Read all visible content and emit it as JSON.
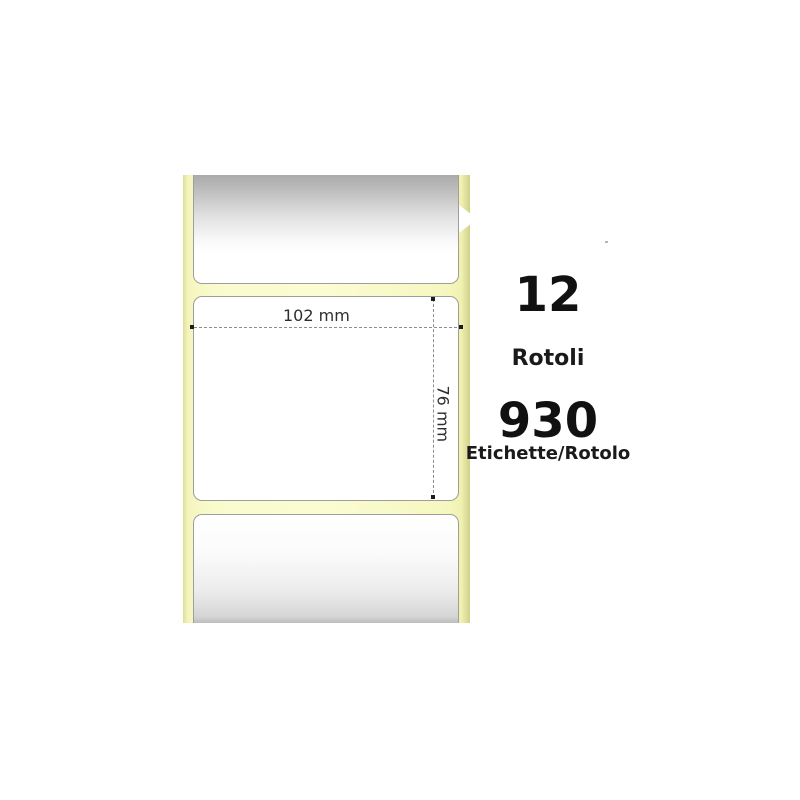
{
  "product_image": {
    "description": "Strip of three blank thermal labels on yellow liner",
    "liner_color": "#fbfcd2",
    "label_border_color": "#9e9e9e"
  },
  "dimensions": {
    "width_label": "102 mm",
    "height_label": "76 mm"
  },
  "info": {
    "rolls_count": "12",
    "rolls_label": "Rotoli",
    "labels_per_roll_count": "930",
    "labels_per_roll_label": "Etichette/Rotolo"
  }
}
